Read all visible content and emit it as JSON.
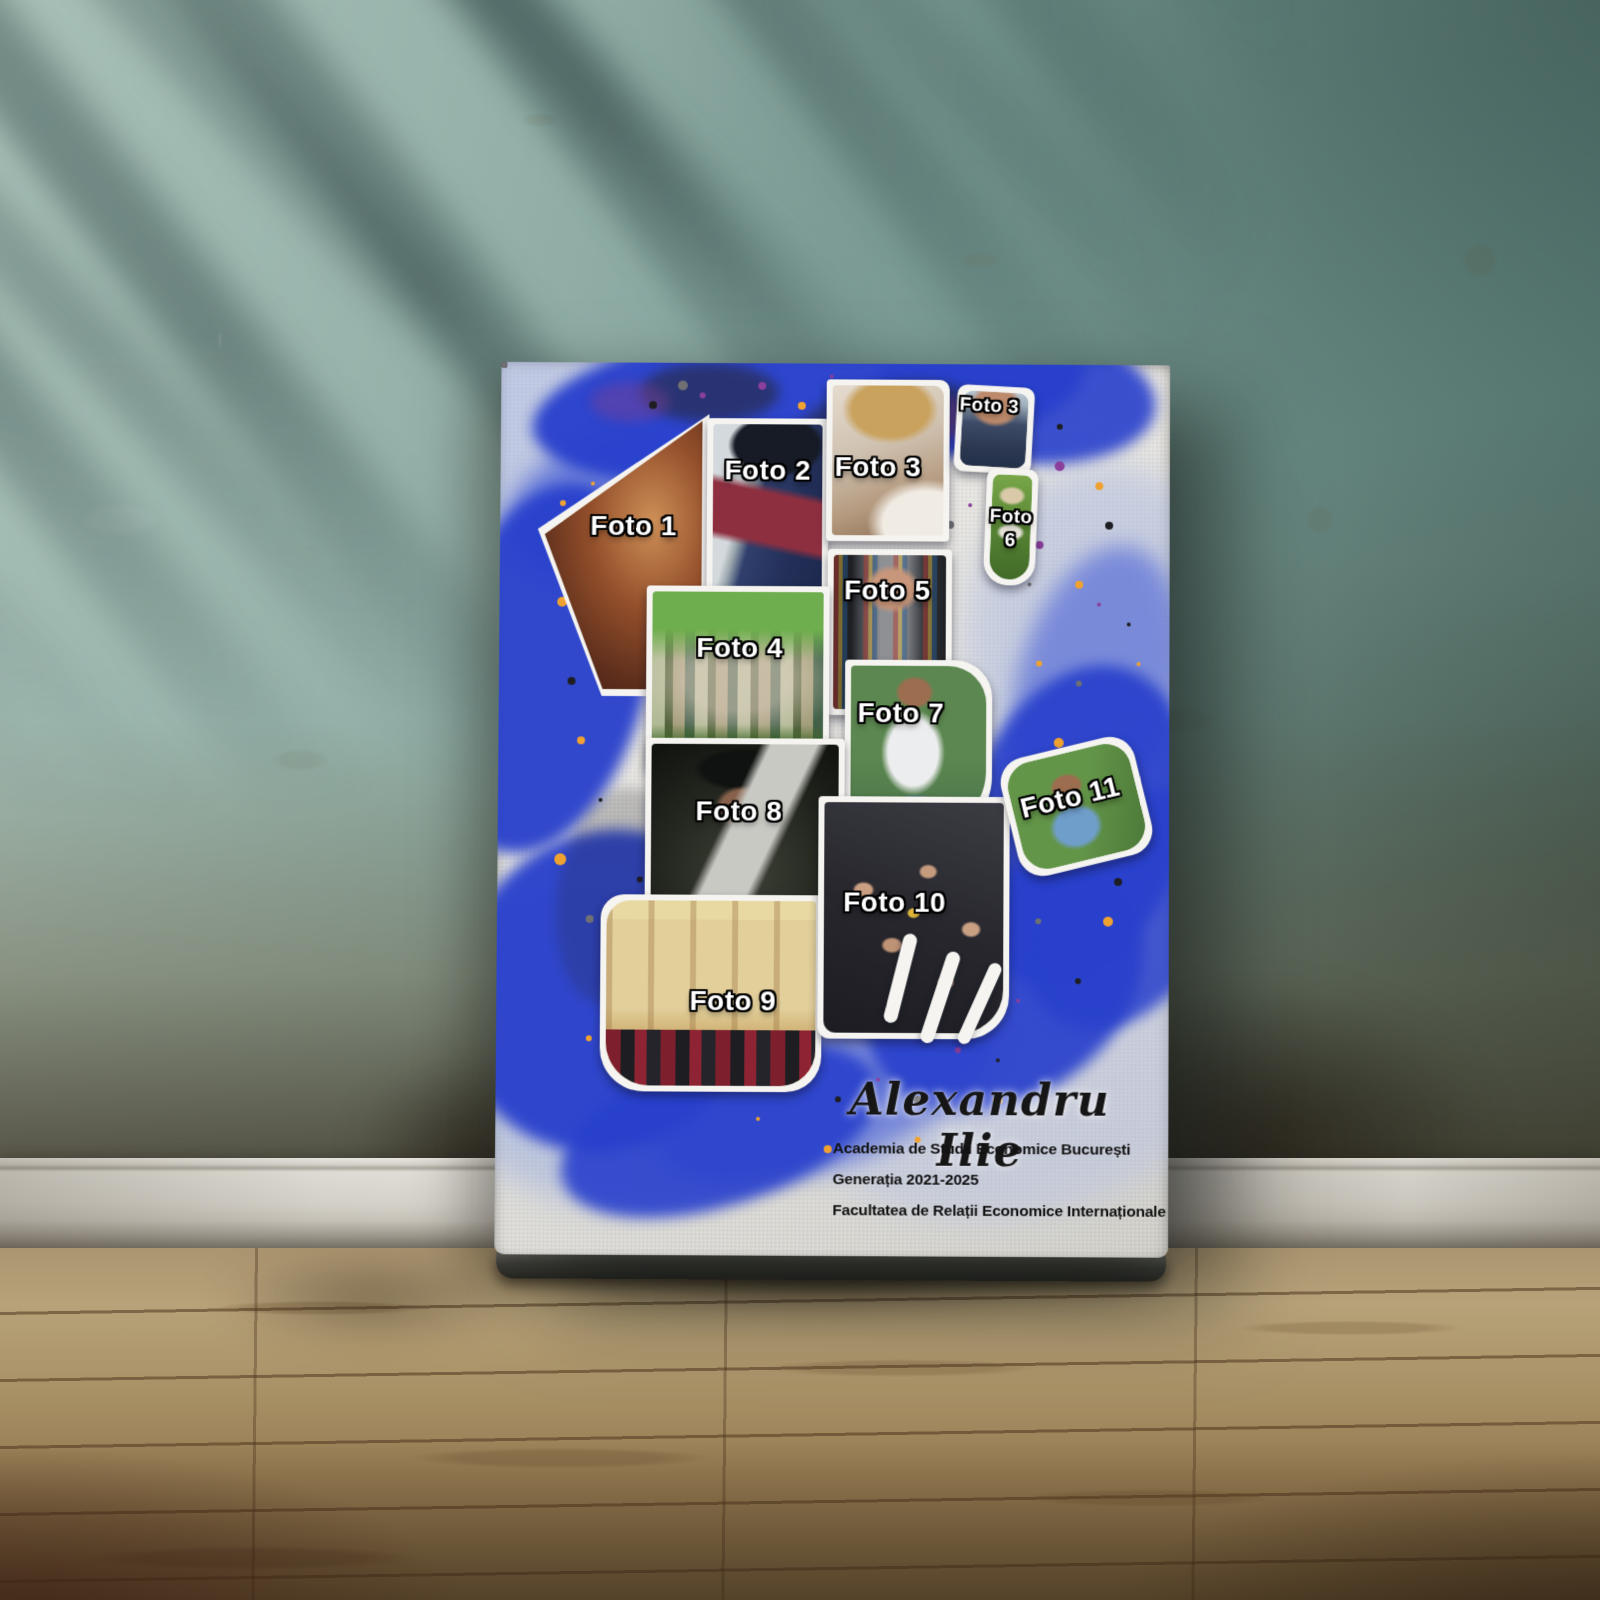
{
  "poster": {
    "photos": [
      {
        "key": "foto-1",
        "label": "Foto 1"
      },
      {
        "key": "foto-2",
        "label": "Foto 2"
      },
      {
        "key": "foto-3-large",
        "label": "Foto 3"
      },
      {
        "key": "foto-3-small",
        "label": "Foto 3"
      },
      {
        "key": "foto-4",
        "label": "Foto 4"
      },
      {
        "key": "foto-5",
        "label": "Foto 5"
      },
      {
        "key": "foto-6",
        "label": "Foto 6"
      },
      {
        "key": "foto-7",
        "label": "Foto 7"
      },
      {
        "key": "foto-8",
        "label": "Foto 8"
      },
      {
        "key": "foto-9",
        "label": "Foto 9"
      },
      {
        "key": "foto-10",
        "label": "Foto 10"
      },
      {
        "key": "foto-11",
        "label": "Foto 11"
      }
    ],
    "graduate_name": "Alexandru Ilie",
    "details": [
      "Academia de Studii Economice București",
      "Generația 2021-2025",
      "Facultatea de Relații Economice Internaționale"
    ],
    "colors": {
      "splash_blue": "#2840cc",
      "splash_periwinkle": "#9fb0e0",
      "splatter_orange": "#f0a231",
      "splatter_purple": "#8a3f9c",
      "splatter_black": "#1e1e22",
      "wall_teal": "#7fa29b",
      "floor_wood": "#a89065"
    }
  }
}
